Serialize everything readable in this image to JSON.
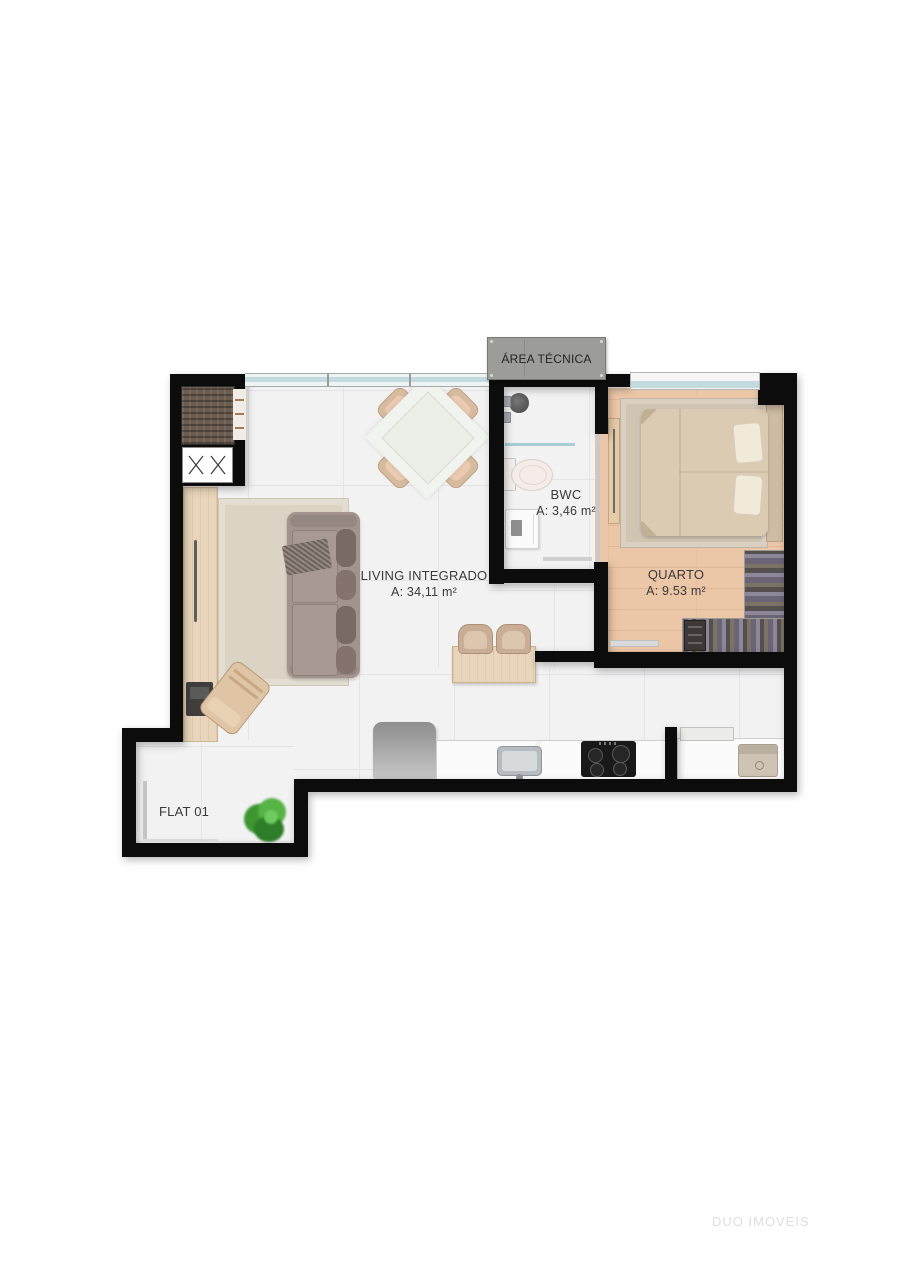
{
  "plan": {
    "unit_label": "FLAT 01",
    "rooms": {
      "area_tecnica": {
        "name": "ÁREA TÉCNICA"
      },
      "living": {
        "name": "LIVING INTEGRADO",
        "area": "A: 34,11 m²"
      },
      "quarto": {
        "name": "QUARTO",
        "area": "A: 9.53 m²"
      },
      "bwc": {
        "name": "BWC",
        "area": "A: 3,46 m²"
      }
    },
    "furniture_icons": [
      "sofa",
      "area-rug",
      "throw-blanket",
      "dining-table",
      "dining-chair",
      "sideboard",
      "desk-chair",
      "laptop",
      "wardrobe",
      "vent-shaft",
      "bar-counter",
      "bar-stool",
      "fridge",
      "kitchen-counter",
      "kitchen-sink",
      "cooktop",
      "laundry-counter",
      "washing-machine",
      "double-bed",
      "pillow",
      "bed-rug",
      "clothes-rack",
      "dresser",
      "tv-panel",
      "shower-head",
      "shower-glass",
      "toilet",
      "vanity-sink",
      "plant",
      "door-leaf",
      "window"
    ]
  },
  "watermark": {
    "text": "DUO IMOVEIS"
  },
  "colors": {
    "wall": "#0c0c0c",
    "tile_floor": "#f2f2f3",
    "wood_floor": "#ecc7a7",
    "window_glass": "#c3dade",
    "concrete_box": "#9c9c9a",
    "rug": "#dbd3c3",
    "sofa": "#a2938c",
    "bed": "#dccbb3",
    "plant_green": "#46a238",
    "label_text": "#3a3a3a",
    "watermark": "#dedede"
  }
}
